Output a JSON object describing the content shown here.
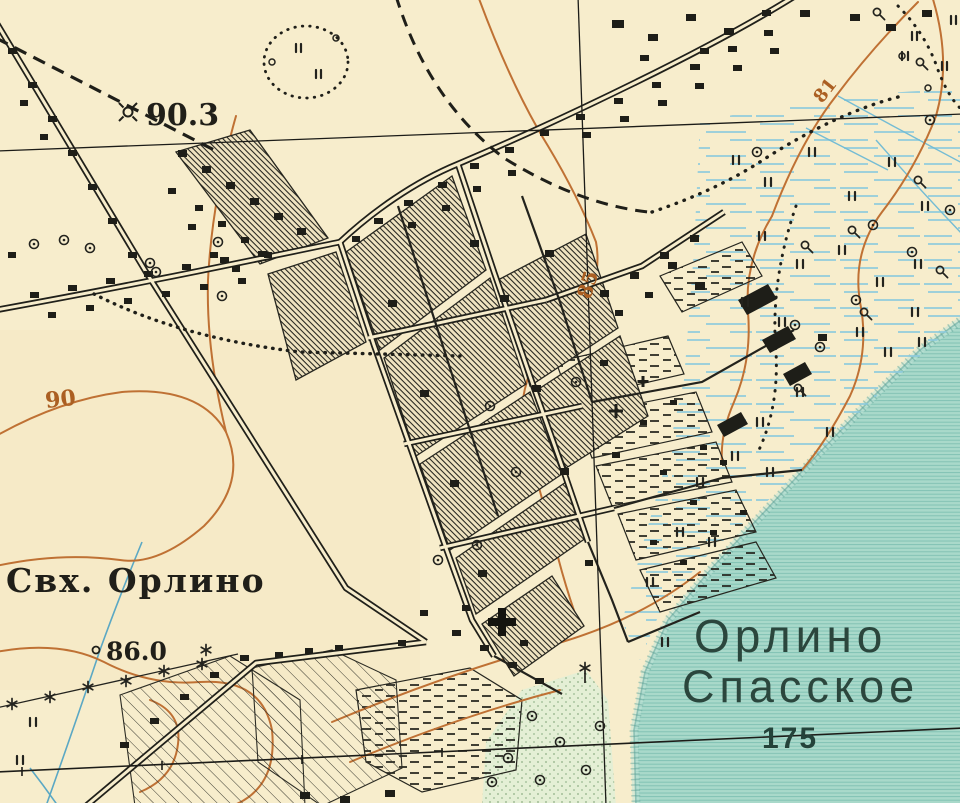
{
  "map": {
    "description": "historical topographic map fragment, Russian",
    "labels": {
      "farm": "Свх. Орлино",
      "lake_name_line1": "Орлино",
      "lake_name_line2": "Спасское",
      "lake_number": "175",
      "spot_height_main": "90.3",
      "spot_height_secondary": "86.0",
      "contour_left": "90",
      "contour_center": "85",
      "contour_right": "81"
    },
    "colors": {
      "paper": "#f7edcc",
      "ink": "#26261f",
      "contour_orange": "#bf7134",
      "water_teal": "#a9d9ca",
      "water_rule": "#7ec0b2",
      "marsh_blue": "#8ccadd",
      "orchard_green": "#e4efd5",
      "label_dark": "#2b463d"
    },
    "symbols": {
      "spot-height-icon": "⊕",
      "tree-icon": "◯",
      "marsh-icon": "∥",
      "bush-icon": "Q",
      "church-cross-icon": "✚",
      "windmill-icon": "✳",
      "pylon-star-icon": "✶"
    }
  }
}
